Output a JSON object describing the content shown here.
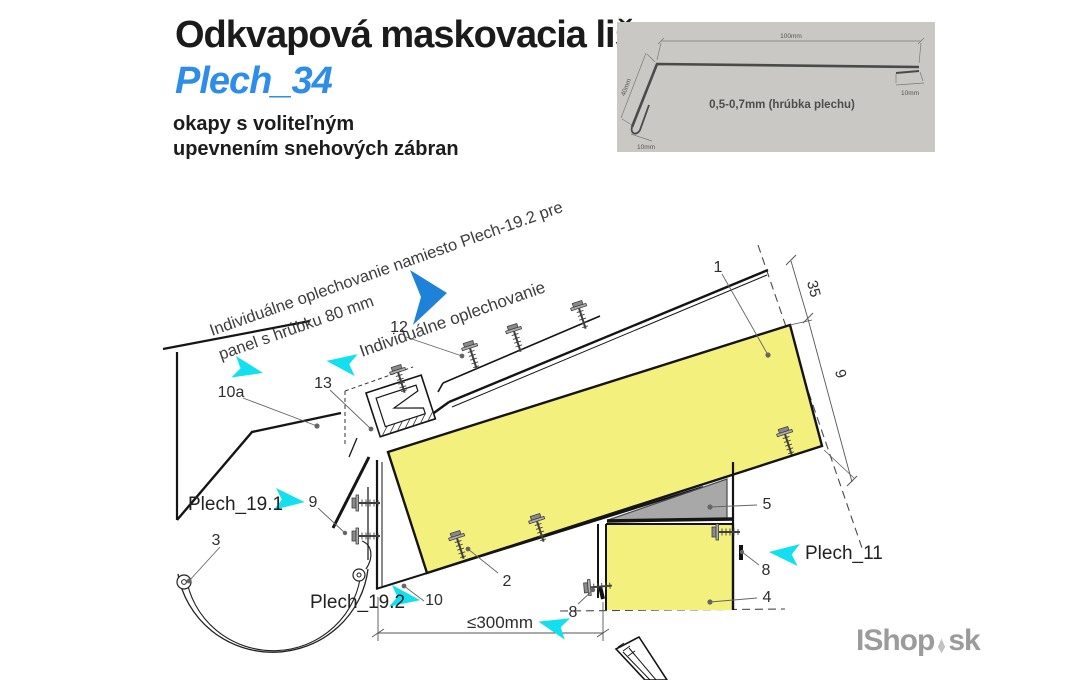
{
  "header": {
    "title": "Odkvapová maskovacia lišta",
    "subtitle": "Plech_34",
    "desc_line1": "okapy s voliteľným",
    "desc_line2": "upevnením snehových zábran"
  },
  "inset": {
    "dim_top": "100mm",
    "dim_right": "10mm",
    "dim_left": "40mm",
    "dim_bottom": "10mm",
    "thickness_note": "0,5-0,7mm (hrúbka plechu)"
  },
  "drawing": {
    "notes": {
      "note1a": "Individuálne oplechovanie namiesto Plech-19.2 pre",
      "note1b": "panel s hrúbku 80 mm",
      "note2": "Individuálne oplechovanie"
    },
    "names": {
      "plech191": "Plech_19.1",
      "plech192": "Plech_19.2",
      "plech11": "Plech_11"
    },
    "dims": {
      "d300": "≤300mm",
      "d35": "35",
      "d9": "9"
    },
    "labels": {
      "n1": "1",
      "n2": "2",
      "n3": "3",
      "n4": "4",
      "n5": "5",
      "n8_right": "8",
      "n8_bottom": "8",
      "n9": "9",
      "n10": "10",
      "n10a": "10a",
      "n12": "12",
      "n13": "13"
    },
    "colors": {
      "panel_yellow": "#f4f07e",
      "wedge_gray": "#a8a8a8",
      "cyan_arrow": "#12dff0",
      "blue_arrow": "#1e82d8",
      "subtitle_blue": "#2d8de8",
      "inset_bg": "#c9c8c5"
    }
  },
  "footer": {
    "brand_left": "IShop",
    "brand_right": "sk"
  }
}
